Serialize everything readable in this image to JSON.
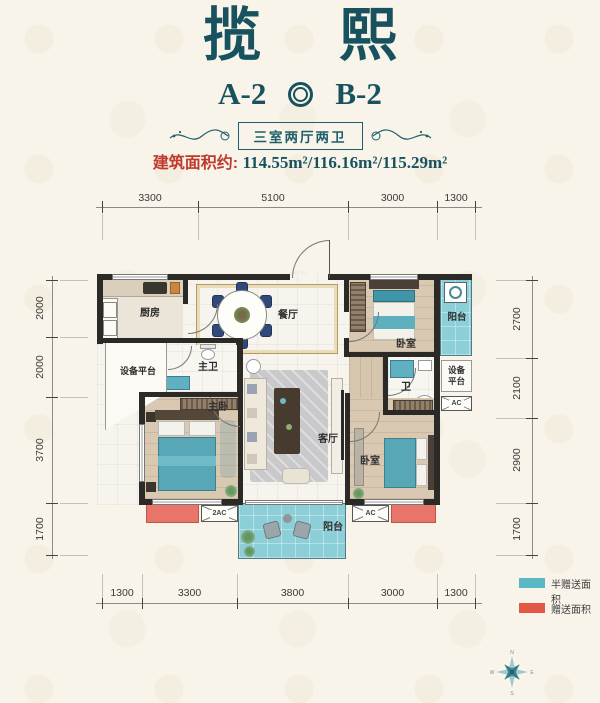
{
  "header": {
    "title_l": "揽",
    "title_r": "熙",
    "unit_a": "A-2",
    "unit_b": "B-2",
    "banner": "三室两厅两卫",
    "area_label": "建筑面积约:",
    "area_values": "114.55m²/116.16m²/115.29m²"
  },
  "dimensions": {
    "top": [
      "3300",
      "5100",
      "3000",
      "1300"
    ],
    "left": [
      "2000",
      "2000",
      "3700",
      "1700"
    ],
    "right": [
      "2700",
      "2100",
      "2900",
      "1700"
    ],
    "bottom": [
      "1300",
      "3300",
      "3800",
      "3000",
      "1300"
    ]
  },
  "rooms": {
    "kitchen": "厨房",
    "dining": "餐厅",
    "bedroom_top": "卧室",
    "balcony_top": "阳台",
    "equip_left": "设备平台",
    "master_bath": "主卫",
    "master_bedroom": "主卧",
    "living": "客厅",
    "bath": "卫",
    "equip_right_l1": "设备",
    "equip_right_l2": "平台",
    "bedroom_bottom": "卧室",
    "balcony_bottom": "阳台"
  },
  "boxes": {
    "ac": "AC",
    "ac2": "2AC"
  },
  "legend": {
    "half_gift": "半赠送面积",
    "half_gift_color": "#5bb7c3",
    "gift": "赠送面积",
    "gift_color": "#e25746"
  },
  "compass": {
    "n": "N",
    "e": "E",
    "s": "S",
    "w": "W"
  },
  "colors": {
    "title": "#17525e",
    "accent_red": "#bf3a2b",
    "wall": "#2c2a26"
  }
}
